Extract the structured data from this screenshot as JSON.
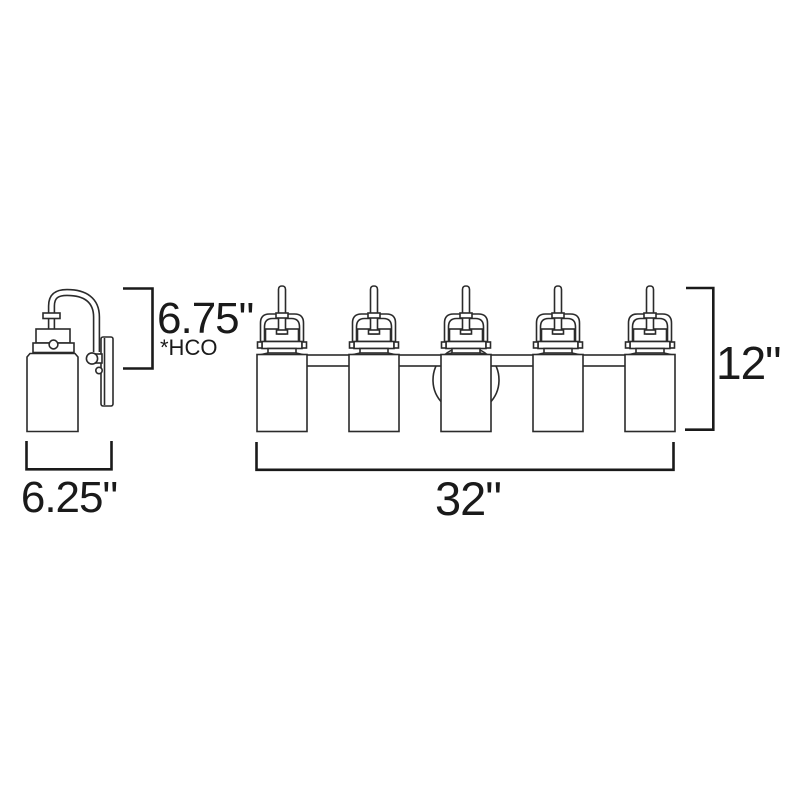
{
  "diagram": {
    "title": "vanity light fixture dimension drawing",
    "side_view": {
      "height_label": "6.75\"",
      "height_note": "*HCO",
      "width_label": "6.25\""
    },
    "front_view": {
      "width_label": "32\"",
      "height_label": "12\"",
      "light_count": 5
    },
    "colors": {
      "line": "#2b2b2b",
      "bracket": "#1a1a1a",
      "text": "#1a1a1a",
      "background": "#ffffff"
    }
  }
}
